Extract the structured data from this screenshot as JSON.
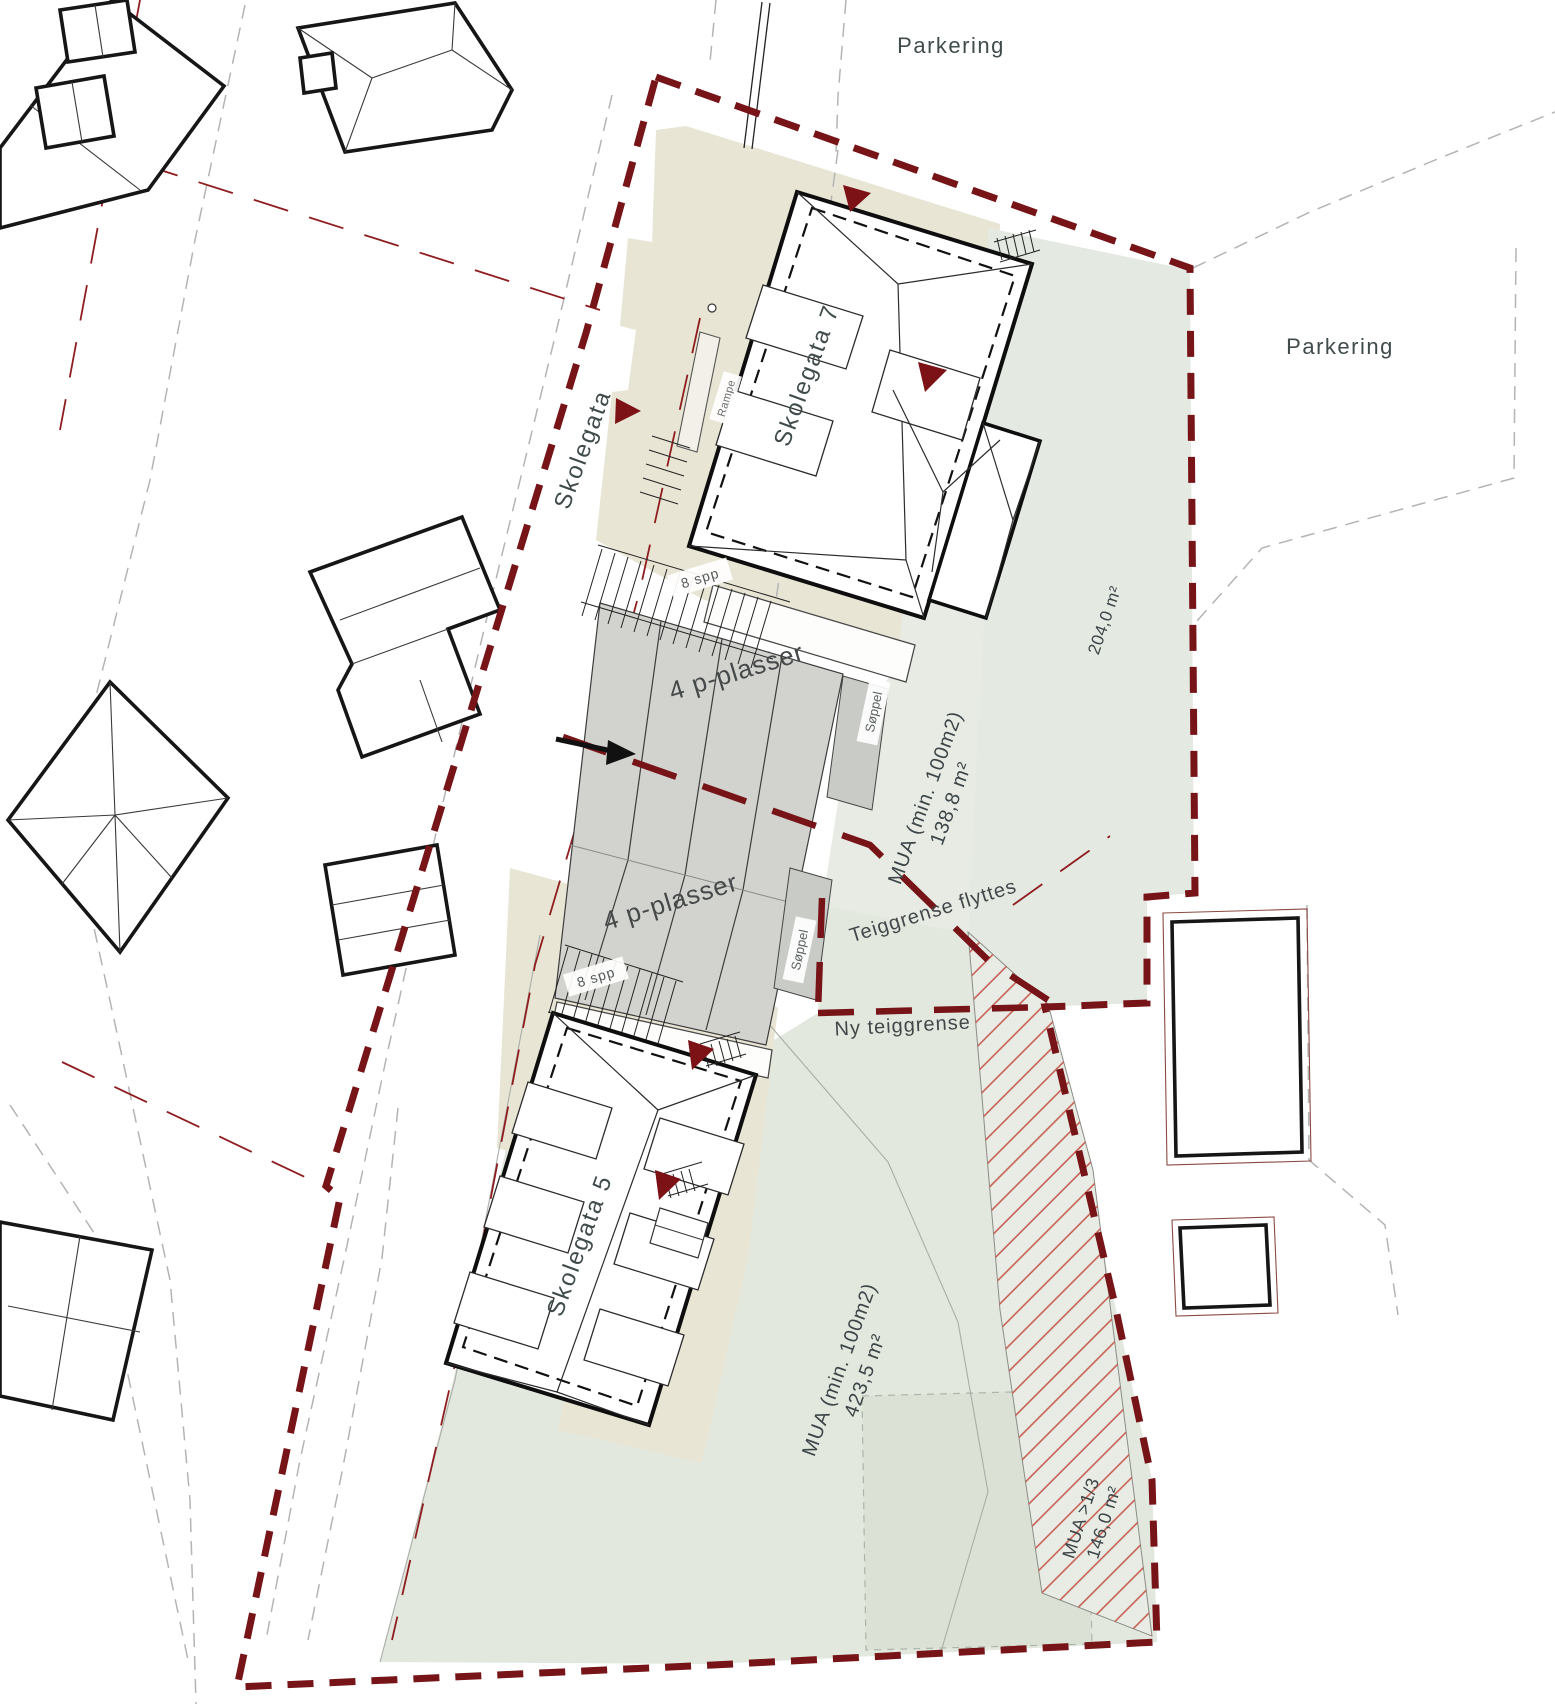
{
  "labels": {
    "parkering_top": "Parkering",
    "parkering_right": "Parkering",
    "street": "Skolegata",
    "building7": "Skolegata 7",
    "building5": "Skolegata 5",
    "rampe": "Rampe",
    "bike_top": "8 spp",
    "bike_bottom": "8 spp",
    "parking_top": "4 p-plasser",
    "parking_bottom": "4 p-plasser",
    "waste_top": "Søppel",
    "waste_bottom": "Søppel",
    "mua_mid_line1": "MUA (min. 100m2)",
    "mua_mid_line2": "138,8 m²",
    "area_strip": "204,0 m²",
    "mua_lower_line1": "MUA (min. 100m2)",
    "mua_lower_line2": "423,5 m²",
    "mua_third_line1": "MUA >1/3",
    "mua_third_line2": "146,0 m²",
    "boundary_moved": "Teiggrense flyttes",
    "boundary_new": "Ny teiggrense"
  },
  "colors": {
    "site_boundary": "#771418",
    "old_boundary": "#8f1d20",
    "entrance_marker": "#7c1216",
    "beige_surface": "#e9e5d4",
    "green_mua": "#e4e9e1",
    "parking_gray": "#d2d3cf",
    "hatch_red": "#c4574b"
  }
}
